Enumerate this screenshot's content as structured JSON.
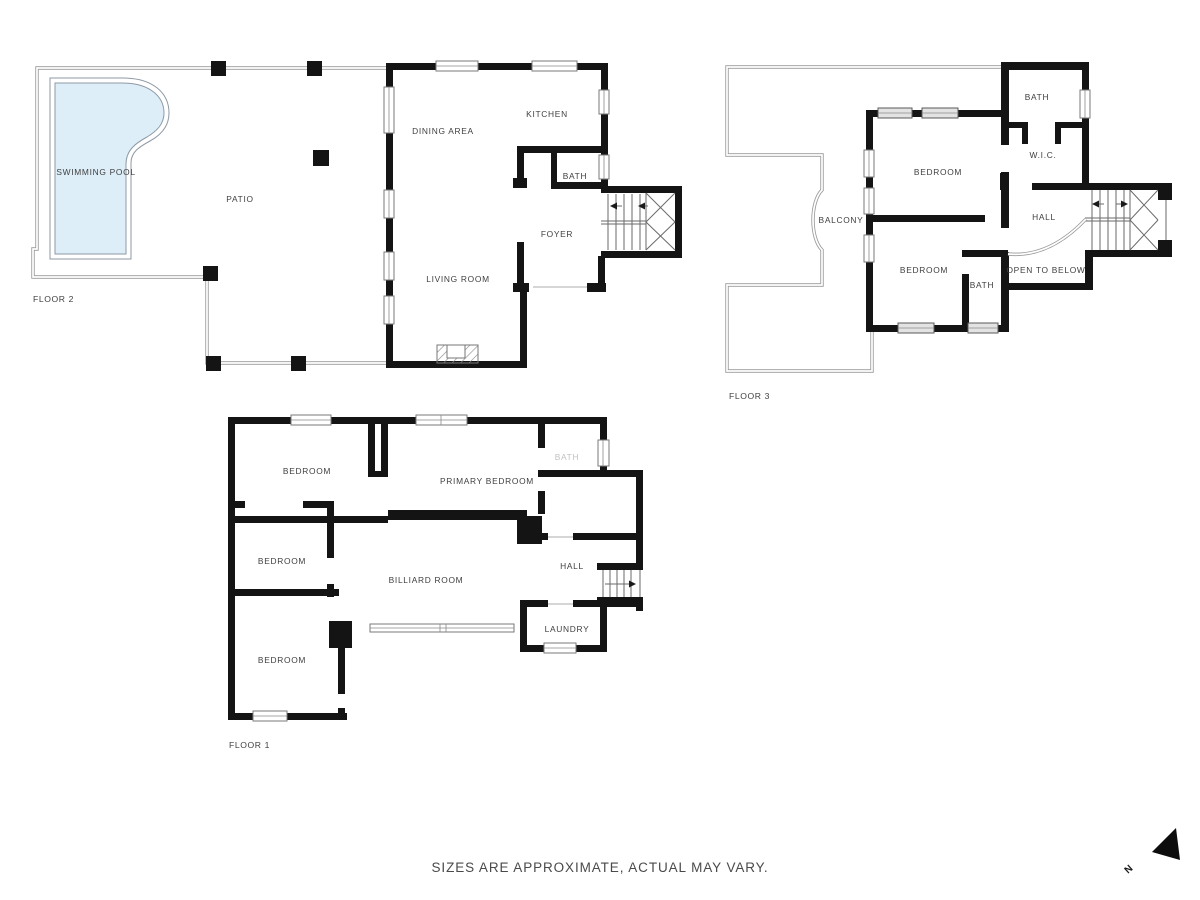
{
  "footer": {
    "disclaimer": "SIZES ARE APPROXIMATE, ACTUAL MAY VARY."
  },
  "compass": {
    "north_letter": "N"
  },
  "colors": {
    "wall": "#141414",
    "thin_outline": "#9a9a9a",
    "pool_water": "#ddeef8",
    "label": "#3f3f3f",
    "faint_label": "#c2c2c2",
    "footer_text": "#4a4a4a"
  },
  "floors": {
    "floor2": {
      "name": "FLOOR 2",
      "rooms": {
        "swimming_pool": "SWIMMING POOL",
        "patio": "PATIO",
        "dining_area": "DINING AREA",
        "kitchen": "KITCHEN",
        "bath": "BATH",
        "foyer": "FOYER",
        "living_room": "LIVING ROOM"
      }
    },
    "floor3": {
      "name": "FLOOR 3",
      "rooms": {
        "bath_top": "BATH",
        "wic": "W.I.C.",
        "bedroom_top": "BEDROOM",
        "balcony": "BALCONY",
        "hall": "HALL",
        "bedroom_bottom": "BEDROOM",
        "bath_bottom": "BATH",
        "open_to_below": "OPEN TO BELOW"
      }
    },
    "floor1": {
      "name": "FLOOR 1",
      "rooms": {
        "bedroom_top_left": "BEDROOM",
        "primary_bedroom": "PRIMARY BEDROOM",
        "bath": "BATH",
        "bedroom_mid_left": "BEDROOM",
        "billiard_room": "BILLIARD ROOM",
        "hall": "HALL",
        "laundry": "LAUNDRY",
        "bedroom_bottom_left": "BEDROOM"
      }
    }
  }
}
